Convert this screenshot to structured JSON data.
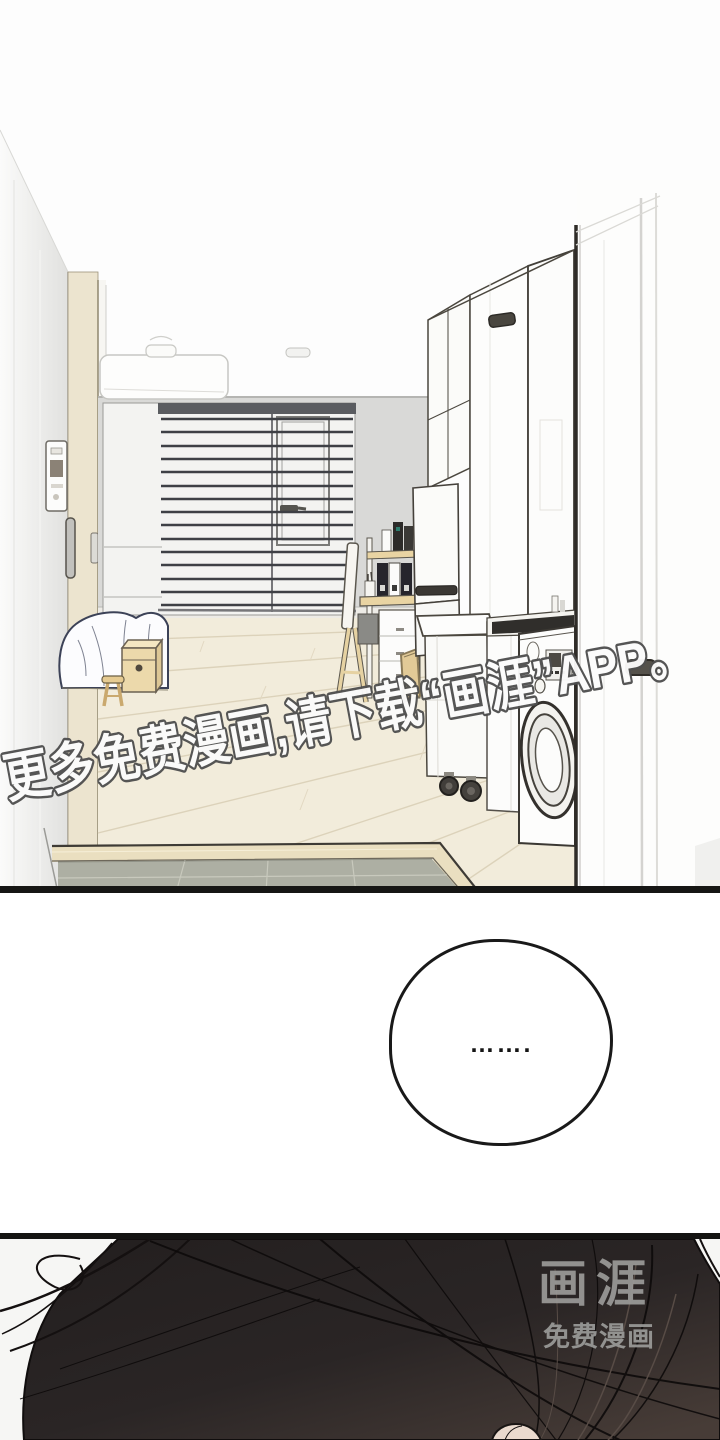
{
  "page": {
    "width": 720,
    "height": 1440,
    "background": "#fdfdfd",
    "kind": "webtoon comic page"
  },
  "watermark": {
    "text": "更多免费漫画,请下载“画涯”APP。",
    "fill_color": "#fbfbfb",
    "outline_color": "#4f4f4f"
  },
  "speech_bubble": {
    "text": "…….",
    "border_color": "#191919",
    "background": "#ffffff"
  },
  "brand_logo": {
    "name": "画涯",
    "tagline": "免费漫画",
    "color": "#9b9b99"
  },
  "panels": [
    {
      "id": "room-scene",
      "description": "studio apartment interior seen from entry hall: window with venetian blinds, air conditioner, bed with white blanket, wooden box, stool, desk with chair and file boxes, refrigerator, tall white cabinets, rolling cart, kitchen counter with cooktop, front-load washing machine, wood floor and tiled entry step"
    },
    {
      "id": "spacer-with-bubble",
      "description": "white gutter containing a silent speech bubble"
    },
    {
      "id": "hair-closeup",
      "description": "close-up of dark hair filling the panel with a small skin patch at bottom center",
      "hair_color": "#2a2524"
    }
  ],
  "colors": {
    "panel_border": "#161614",
    "wall_gray": "#d9d9d7",
    "floor_wood": "#f2ecdb",
    "entry_tile": "#adafa3",
    "furniture_wood": "#ecd9ab",
    "blind_slats": "#3e4045"
  }
}
